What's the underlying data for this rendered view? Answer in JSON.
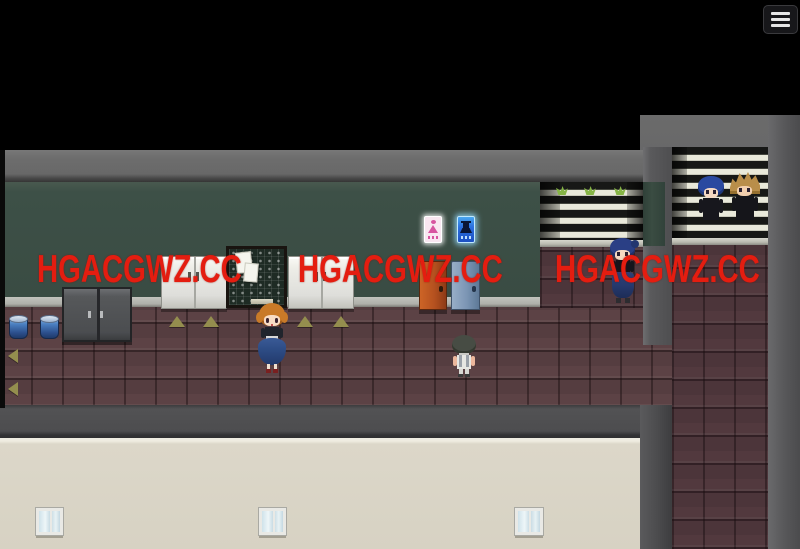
{
  "app": {
    "type": "rpg-game-screenshot",
    "scene_description": "school hallway with classroom doors, lockers and students"
  },
  "menu": {
    "icon": "hamburger-menu-icon"
  },
  "watermark": {
    "text": "HGACGWZ.CC",
    "color": "#e41d10",
    "count": 3
  },
  "scene": {
    "signs": [
      {
        "name": "female-restroom-sign",
        "color": "#d855a0"
      },
      {
        "name": "male-restroom-sign",
        "color": "#2a6fe0"
      }
    ],
    "doors": [
      {
        "name": "orange-door",
        "color": "#b5511f"
      },
      {
        "name": "blue-door",
        "color": "#7b95b4"
      }
    ],
    "characters": [
      {
        "name": "girl-orange-hair",
        "hair": "#c97a28",
        "outfit": "black top, long blue skirt"
      },
      {
        "name": "student-gray-hair",
        "hair": "#474c44",
        "outfit": "white shirt with straps"
      },
      {
        "name": "student-blue-hair-hallway",
        "hair": "#2a3f85",
        "outfit": "black top, blue hakama"
      },
      {
        "name": "student-blue-hair-window",
        "hair": "#2a49a0",
        "outfit": "black uniform"
      },
      {
        "name": "student-blonde-hair-window",
        "hair": "#b98e4a",
        "outfit": "black uniform"
      }
    ],
    "palette": {
      "void": "#000000",
      "floor_brick": "#5c4245",
      "chalkboard_wall": "#3d5047",
      "gray_wall": "#6d6d6d",
      "lower_wall_beige": "#d9d4c6",
      "blinds_light": "#e9e9da",
      "blinds_dark": "#171816"
    }
  }
}
